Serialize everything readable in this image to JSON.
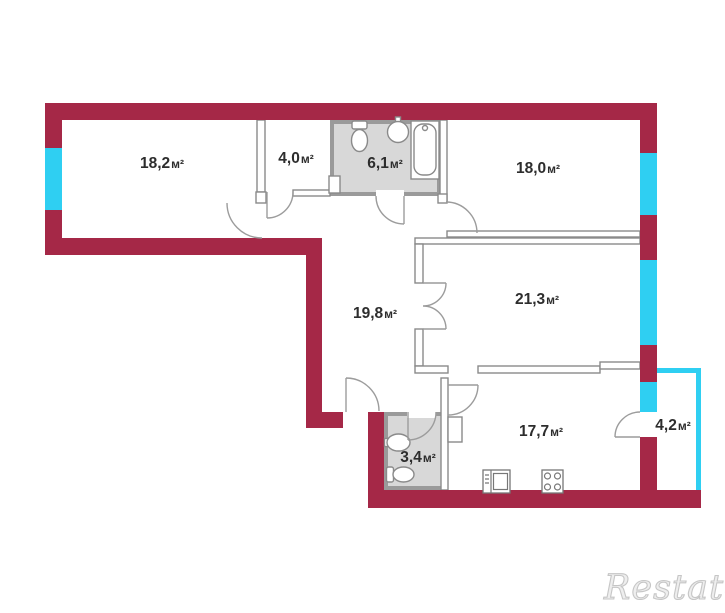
{
  "plan": {
    "kind": "apartment-floor-plan",
    "units_note": "areas shown in square meters"
  },
  "colors": {
    "wall": "#A52847",
    "window": "#2FCFF2",
    "balcony_rail": "#2FCFF2",
    "bathroom_fill": "#D8D8D8",
    "bathroom_wall": "#9A9A9A",
    "partition": "#8A8A8A",
    "door_arc": "#9C9C9C",
    "label_text": "#2D2D2D",
    "watermark_text": "#C6C6C6"
  },
  "rooms": [
    {
      "id": "room-1",
      "value": "18,2",
      "unit": "м²"
    },
    {
      "id": "entry-hall",
      "value": "4,0",
      "unit": "м²"
    },
    {
      "id": "bathroom",
      "value": "6,1",
      "unit": "м²"
    },
    {
      "id": "room-2",
      "value": "18,0",
      "unit": "м²"
    },
    {
      "id": "hallway",
      "value": "19,8",
      "unit": "м²"
    },
    {
      "id": "room-3",
      "value": "21,3",
      "unit": "м²"
    },
    {
      "id": "wc",
      "value": "3,4",
      "unit": "м²"
    },
    {
      "id": "kitchen",
      "value": "17,7",
      "unit": "м²"
    },
    {
      "id": "balcony",
      "value": "4,2",
      "unit": "м²"
    }
  ],
  "icons": [
    "toilet-icon",
    "sink-icon",
    "bathtub-icon",
    "wc-sink-icon",
    "wc-toilet-icon",
    "oven-icon",
    "stove-icon"
  ],
  "watermark": {
    "text": "Restate"
  }
}
